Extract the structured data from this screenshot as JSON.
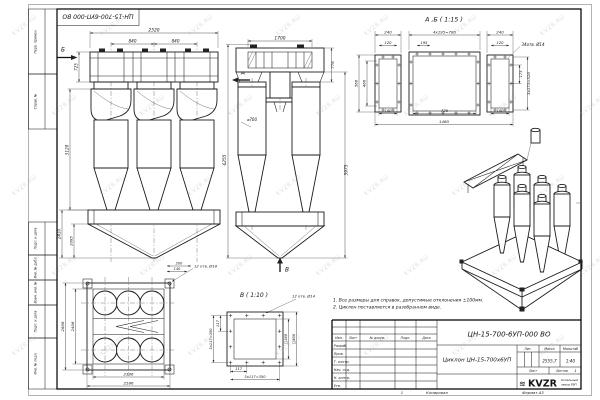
{
  "watermark": {
    "text": "KVZR.RU"
  },
  "stamp": {
    "doc_number": "ЦН-15-700-6УП-000 ВО"
  },
  "margin": {
    "items": [
      "Перв. примен.",
      "Справ. №",
      "Подп. и дата",
      "Инв. № дубл.",
      "Взам. инв. №",
      "Подп. и дата",
      "Инв. № подл."
    ]
  },
  "front_view": {
    "label_b": "Б",
    "label_a": "А",
    "dim_width_total": "2520",
    "dim_bay_1": "840",
    "dim_bay_2": "840",
    "dim_inlet_height": "725",
    "dim_body_height": "3120",
    "dim_hopper_height": "2410",
    "dim_cone_height": "2085"
  },
  "side_view": {
    "dim_width_top": "1700",
    "dim_flange_offset": "776",
    "dim_height_total": "6255",
    "dim_height_body": "5975",
    "dim_diameter": "⌀700",
    "label_v": "В"
  },
  "section_ab": {
    "title": "А ,Б ( 1:15 )",
    "dim_240_left": "240",
    "dim_pitch": "4x195=780",
    "dim_240_right": "240",
    "dim_120_left": "120",
    "dim_195": "195",
    "dim_120_right": "120",
    "holes_note": "34отв. Ø14",
    "dim_560": "560",
    "dim_460": "460",
    "dim_173": "173",
    "dim_520": "3x173=520",
    "dim_180_left": "180",
    "dim_720": "720",
    "dim_180_right": "180",
    "dim_1460": "1460"
  },
  "plan_view": {
    "dim_2606": "2606",
    "dim_2406": "2406",
    "dim_2386": "2386",
    "dim_2586": "2586",
    "dim_200": "200",
    "dim_140": "140",
    "holes_note": "12 отв. Ø18"
  },
  "detail_v": {
    "title": "В ( 1:10 )",
    "holes_note": "12 отв. Ø14",
    "dim_117_left": "117",
    "dim_350_left": "3x117=350",
    "dim_117_bottom": "117",
    "dim_350_bottom": "3x117=350",
    "dim_sq360": "□360",
    "dim_sq400": "□400"
  },
  "notes": {
    "line1": "1. Все размеры для справок, допустимые отклонения ±100мм.",
    "line2": "2. Циклон поставляется в разобранном виде."
  },
  "title_block": {
    "doc_number": "ЦН-15-700-6УП-000 ВО",
    "part_name": "Циклон ЦН-15-700х6УП",
    "lit_label": "Лит.",
    "mass_label": "Масса",
    "scale_label": "Масштаб",
    "mass_value": "2555,7",
    "scale_value": "1:40",
    "sheet_label": "Лист",
    "sheets_label": "Листов",
    "sheets_value": "1",
    "col_izm": "Изм.",
    "col_list": "Лист",
    "col_doc": "№ докум.",
    "col_podp": "Подп.",
    "col_data": "Дата",
    "rows": [
      "Разраб.",
      "Пров.",
      "Т. контр.",
      "Нач. отд.",
      "Н. контр.",
      "Утв."
    ],
    "logo_wave": "≋",
    "logo_text": "KVZR",
    "company_line1": "Котельный",
    "company_line2": "завод РЭП"
  },
  "footer": {
    "num": "1",
    "copied": "Копировал",
    "format": "Формат А3"
  }
}
